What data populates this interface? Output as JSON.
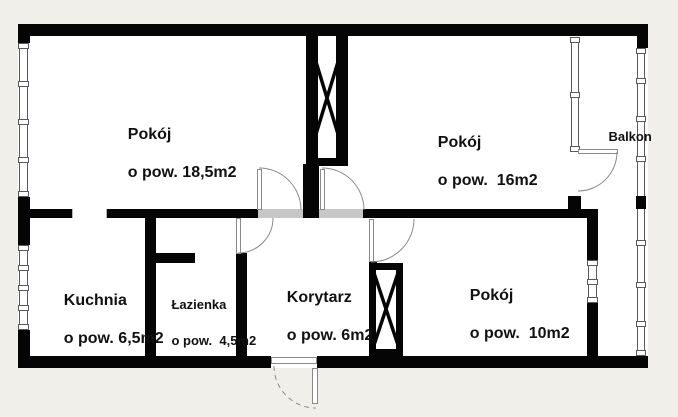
{
  "floorplan": {
    "colors": {
      "background": "#f1efea",
      "floor": "#ffffff",
      "wall": "#050505",
      "door_leaf": "#8a8a8a",
      "swing_arc": "#8a8a8a"
    },
    "rooms": [
      {
        "name": "Pokój",
        "area": "o pow. 18,5m2"
      },
      {
        "name": "Pokój",
        "area": "o pow.  16m2"
      },
      {
        "name": "Balkon",
        "area": ""
      },
      {
        "name": "Kuchnia",
        "area": "o pow. 6,5m2"
      },
      {
        "name": "Łazienka",
        "area": "o pow.  4,5m2"
      },
      {
        "name": "Korytarz",
        "area": "o pow. 6m2"
      },
      {
        "name": "Pokój",
        "area": "o pow.  10m2"
      }
    ]
  }
}
